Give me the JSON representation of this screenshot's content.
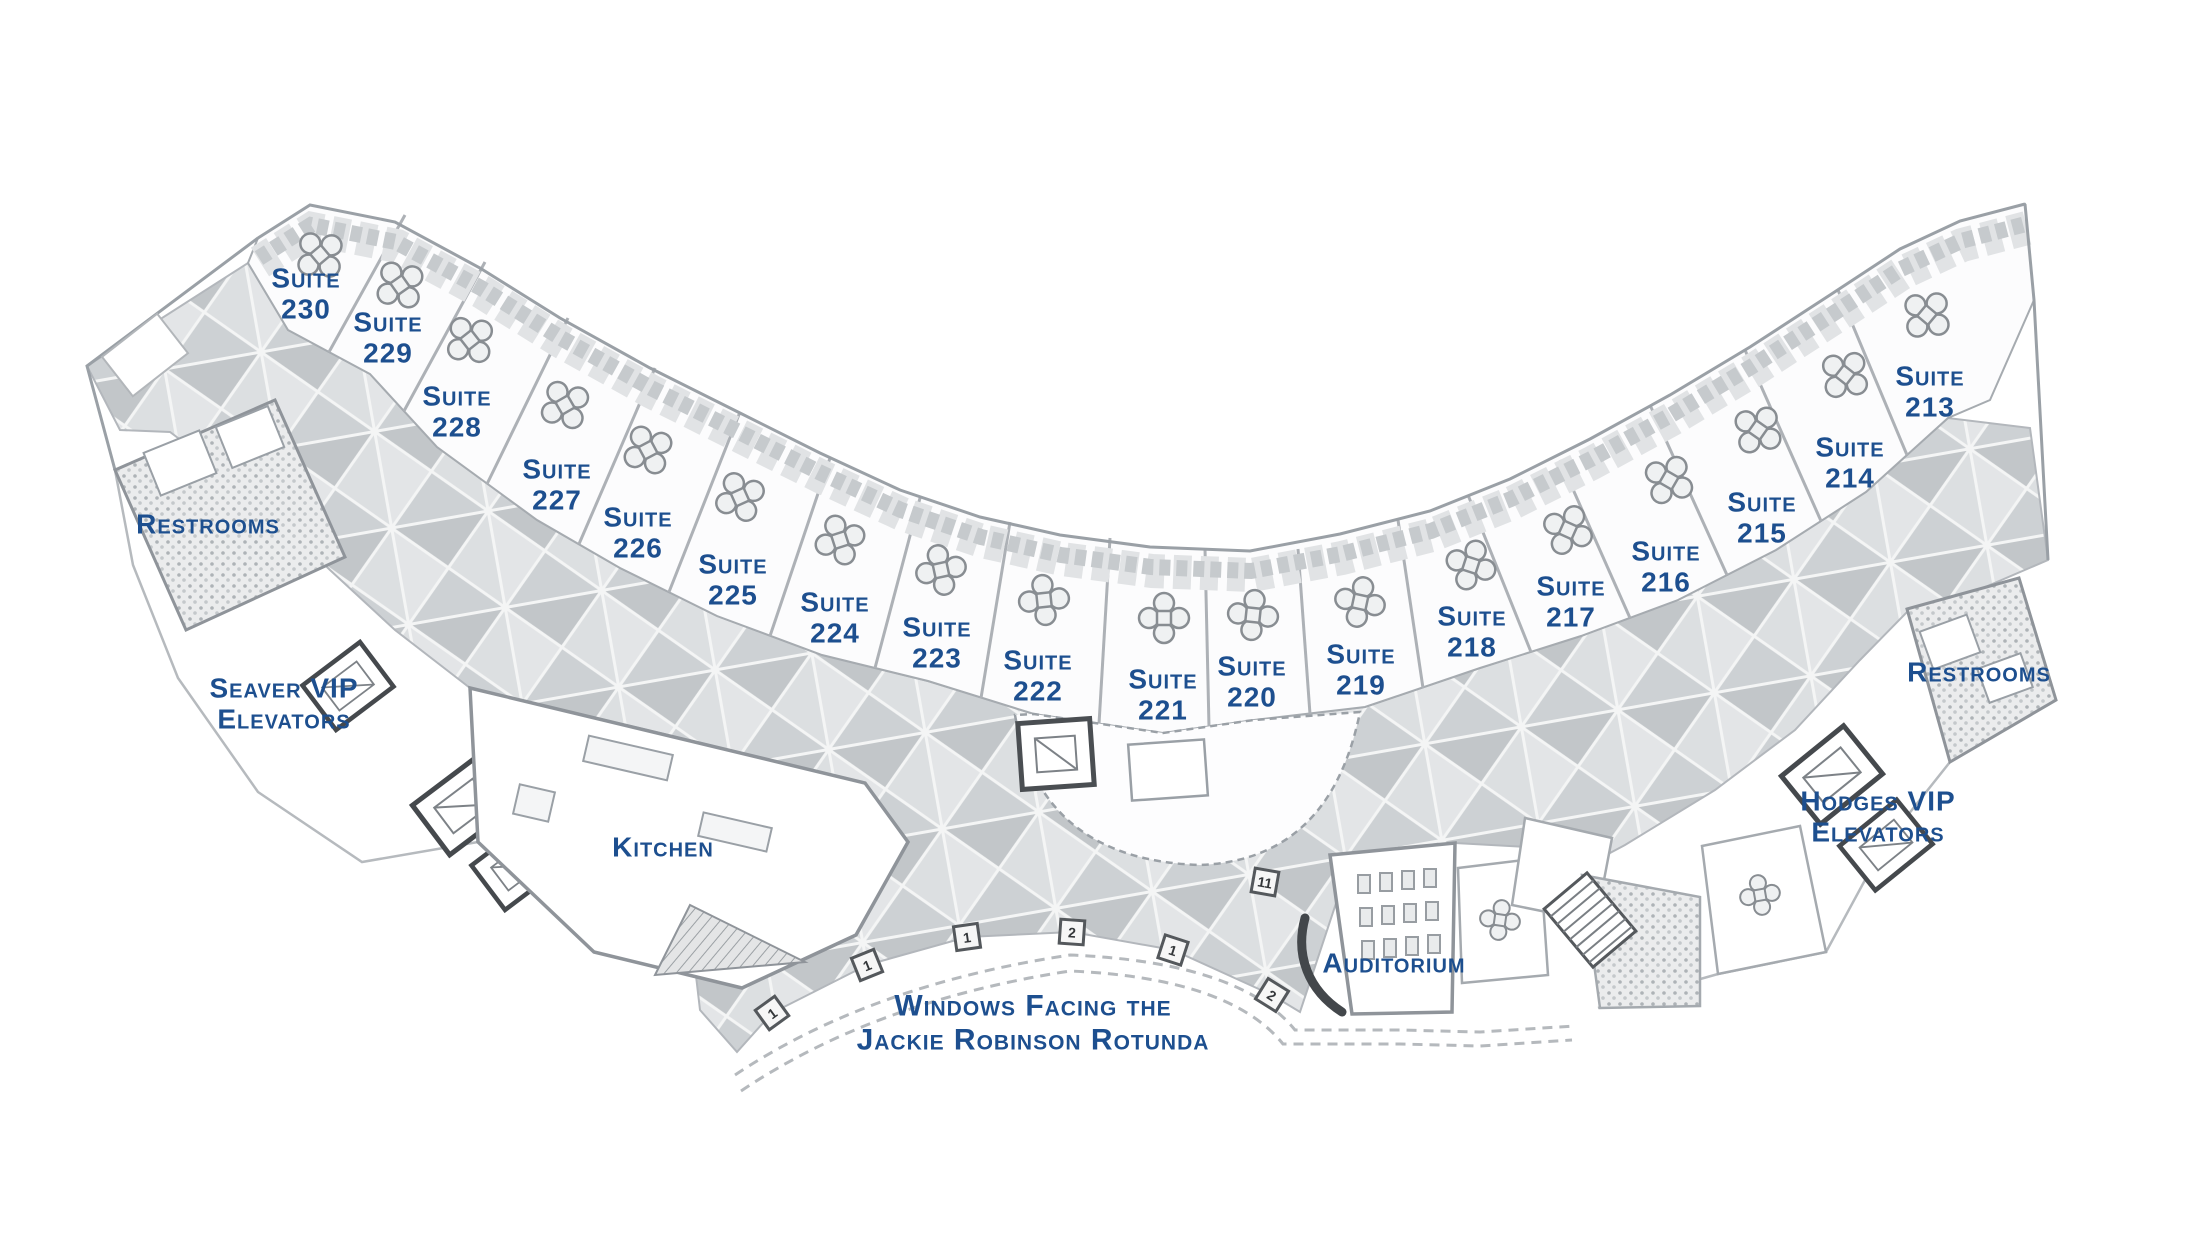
{
  "colors": {
    "label_blue": "#1d4f8f",
    "wall_gray": "#8f949a",
    "tile_dark": "#b4b7ba",
    "tile_light": "#d9dbdd",
    "background": "#ffffff"
  },
  "plan": {
    "labels": [
      {
        "name": "suite-230",
        "lines": [
          "Suite",
          "230"
        ],
        "x": 306,
        "y": 294
      },
      {
        "name": "suite-229",
        "lines": [
          "Suite",
          "229"
        ],
        "x": 388,
        "y": 338
      },
      {
        "name": "suite-228",
        "lines": [
          "Suite",
          "228"
        ],
        "x": 457,
        "y": 412
      },
      {
        "name": "suite-227",
        "lines": [
          "Suite",
          "227"
        ],
        "x": 557,
        "y": 485
      },
      {
        "name": "suite-226",
        "lines": [
          "Suite",
          "226"
        ],
        "x": 638,
        "y": 533
      },
      {
        "name": "suite-225",
        "lines": [
          "Suite",
          "225"
        ],
        "x": 733,
        "y": 580
      },
      {
        "name": "suite-224",
        "lines": [
          "Suite",
          "224"
        ],
        "x": 835,
        "y": 618
      },
      {
        "name": "suite-223",
        "lines": [
          "Suite",
          "223"
        ],
        "x": 937,
        "y": 643
      },
      {
        "name": "suite-222",
        "lines": [
          "Suite",
          "222"
        ],
        "x": 1038,
        "y": 676
      },
      {
        "name": "suite-221",
        "lines": [
          "Suite",
          "221"
        ],
        "x": 1163,
        "y": 695
      },
      {
        "name": "suite-220",
        "lines": [
          "Suite",
          "220"
        ],
        "x": 1252,
        "y": 682
      },
      {
        "name": "suite-219",
        "lines": [
          "Suite",
          "219"
        ],
        "x": 1361,
        "y": 670
      },
      {
        "name": "suite-218",
        "lines": [
          "Suite",
          "218"
        ],
        "x": 1472,
        "y": 632
      },
      {
        "name": "suite-217",
        "lines": [
          "Suite",
          "217"
        ],
        "x": 1571,
        "y": 602
      },
      {
        "name": "suite-216",
        "lines": [
          "Suite",
          "216"
        ],
        "x": 1666,
        "y": 567
      },
      {
        "name": "suite-215",
        "lines": [
          "Suite",
          "215"
        ],
        "x": 1762,
        "y": 518
      },
      {
        "name": "suite-214",
        "lines": [
          "Suite",
          "214"
        ],
        "x": 1850,
        "y": 463
      },
      {
        "name": "suite-213",
        "lines": [
          "Suite",
          "213"
        ],
        "x": 1930,
        "y": 392
      },
      {
        "name": "restrooms-left",
        "lines": [
          "Restrooms"
        ],
        "x": 208,
        "y": 524
      },
      {
        "name": "seaver-vip-elevators",
        "lines": [
          "Seaver VIP",
          "Elevators"
        ],
        "x": 284,
        "y": 704
      },
      {
        "name": "kitchen",
        "lines": [
          "Kitchen"
        ],
        "x": 663,
        "y": 847
      },
      {
        "name": "rotunda-note",
        "lines": [
          "Windows Facing the",
          "Jackie Robinson Rotunda"
        ],
        "x": 1033,
        "y": 1023
      },
      {
        "name": "auditorium",
        "lines": [
          "Auditorium"
        ],
        "x": 1394,
        "y": 963
      },
      {
        "name": "restrooms-right",
        "lines": [
          "Restrooms"
        ],
        "x": 1979,
        "y": 672
      },
      {
        "name": "hodges-vip-elevators",
        "lines": [
          "Hodges VIP",
          "Elevators"
        ],
        "x": 1878,
        "y": 817
      }
    ],
    "window_markers": [
      {
        "n": "1",
        "x": 772,
        "y": 1013,
        "r": -36
      },
      {
        "n": "1",
        "x": 867,
        "y": 965,
        "r": -22
      },
      {
        "n": "1",
        "x": 967,
        "y": 937,
        "r": -8
      },
      {
        "n": "2",
        "x": 1072,
        "y": 932,
        "r": 4
      },
      {
        "n": "1",
        "x": 1173,
        "y": 950,
        "r": 18
      },
      {
        "n": "2",
        "x": 1272,
        "y": 995,
        "r": 32
      },
      {
        "n": "11",
        "x": 1265,
        "y": 882,
        "r": 10
      }
    ]
  }
}
